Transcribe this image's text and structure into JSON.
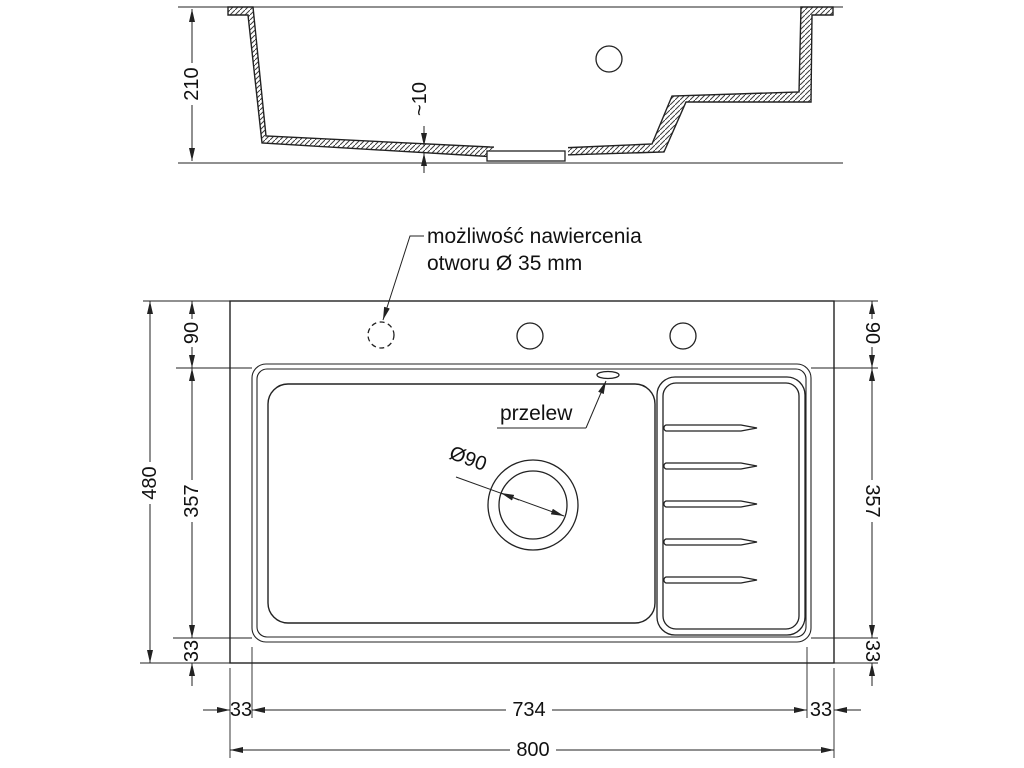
{
  "drawing": {
    "background": "#ffffff",
    "line_color": "#222222",
    "section": {
      "overall_depth": "210",
      "bottom_thickness": "~10"
    },
    "plan": {
      "annotation_line1": "możliwość nawiercenia",
      "annotation_line2": "otworu Ø 35 mm",
      "overflow_label": "przelew",
      "drain_diameter": "Ø90",
      "dims": {
        "overall_width": "800",
        "cutout_width": "734",
        "overall_height": "480",
        "bowl_zone_height_left": "357",
        "bowl_zone_height_right": "357",
        "top_offset_left": "90",
        "top_offset_right": "90",
        "bottom_offset_left": "33",
        "bottom_offset_right": "33",
        "side_offset_left": "33",
        "side_offset_right": "33"
      }
    }
  }
}
